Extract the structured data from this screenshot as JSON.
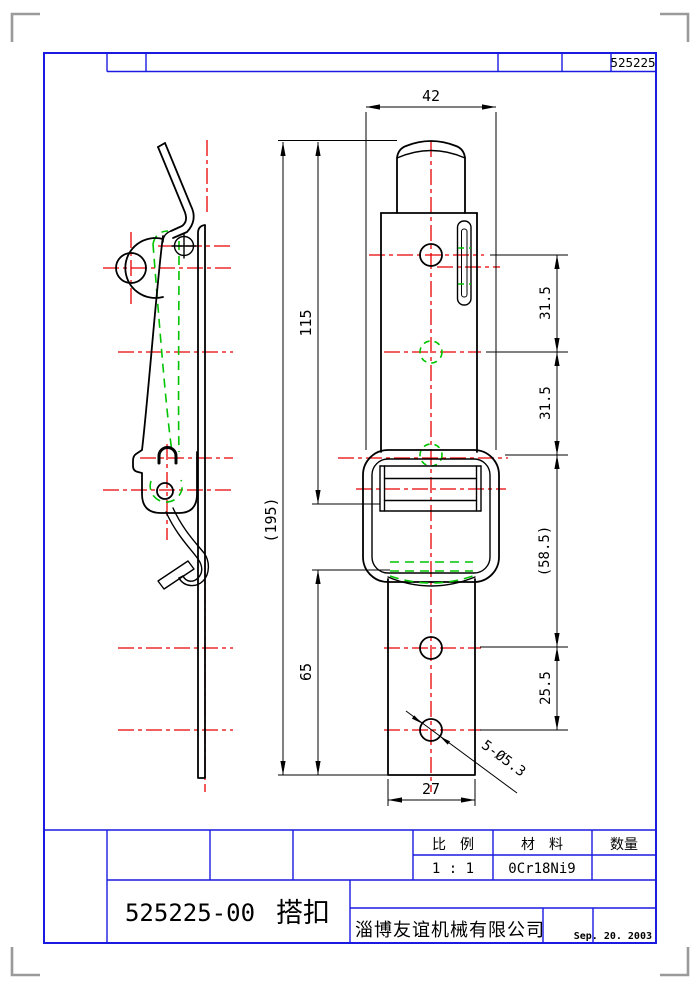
{
  "header": {
    "drawing_no": "525225"
  },
  "dims": {
    "top_width": "42",
    "len115": "115",
    "len195": "(195)",
    "len65": "65",
    "pitch1": "31.5",
    "pitch2": "31.5",
    "pitch3": "(58.5)",
    "pitch4": "25.5",
    "bottom_width": "27",
    "hole_callout": "5-Ø5.3"
  },
  "title_block": {
    "scale_label": "比　例",
    "material_label": "材　料",
    "quantity_label": "数量",
    "scale_value": "1 : 1",
    "material_value": "0Cr18Ni9",
    "quantity_value": "",
    "part_number": "525225-00",
    "part_name": "搭扣",
    "company": "淄博友谊机械有限公司",
    "date": "Sep. 20. 2003"
  },
  "colors": {
    "frame_blue": "#1a1ae0",
    "centerline_red": "#e60000",
    "phantom_green": "#00c400",
    "outline_black": "#000000",
    "corner_mark_gray": "#9a9a9a"
  }
}
